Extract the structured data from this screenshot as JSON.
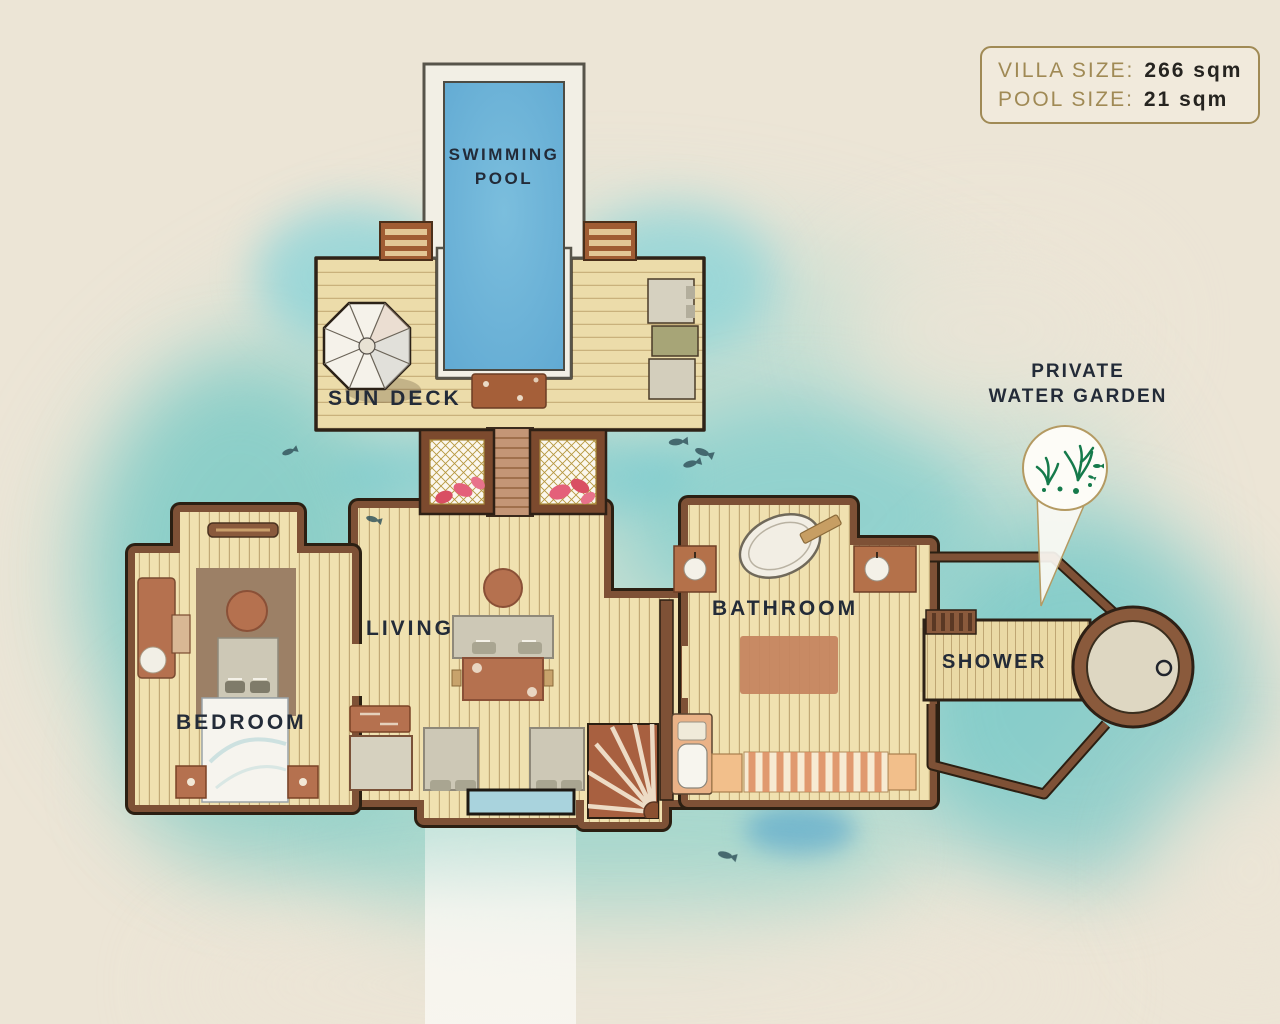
{
  "title": "Villa floor plan",
  "info_box": {
    "rows": [
      {
        "label": "VILLA SIZE:",
        "value": "266 sqm"
      },
      {
        "label": "POOL SIZE:",
        "value": "21 sqm"
      }
    ]
  },
  "labels": {
    "swimming_pool_line1": "SWIMMING",
    "swimming_pool_line2": "POOL",
    "sun_deck": "SUN DECK",
    "living": "LIVING",
    "bedroom": "BEDROOM",
    "bathroom": "BATHROOM",
    "shower": "SHOWER",
    "water_garden_line1": "PRIVATE",
    "water_garden_line2": "WATER GARDEN"
  },
  "icons": {
    "umbrella": "parasol-icon",
    "water_garden_pin": "map-pin-icon",
    "seaweed": "seaweed-icon",
    "fish": "fish-icon",
    "shower_head": "shower-drain-icon"
  },
  "colors": {
    "paper": "#ece5d6",
    "water_teal": "#7ccfca",
    "water_deep": "#58bfc2",
    "pool_blue": "#68b2d8",
    "deck_tan": "#ecdcaa",
    "floor_tan": "#f0e1b0",
    "wall_brown": "#7e5136",
    "wall_outline": "#2b1f12",
    "furniture_terracotta": "#b5714f",
    "furniture_gray": "#cdc8b6",
    "text_navy": "#232b38",
    "info_gold": "#a08a55",
    "info_value": "#262420",
    "garden_green": "#157a4b"
  }
}
